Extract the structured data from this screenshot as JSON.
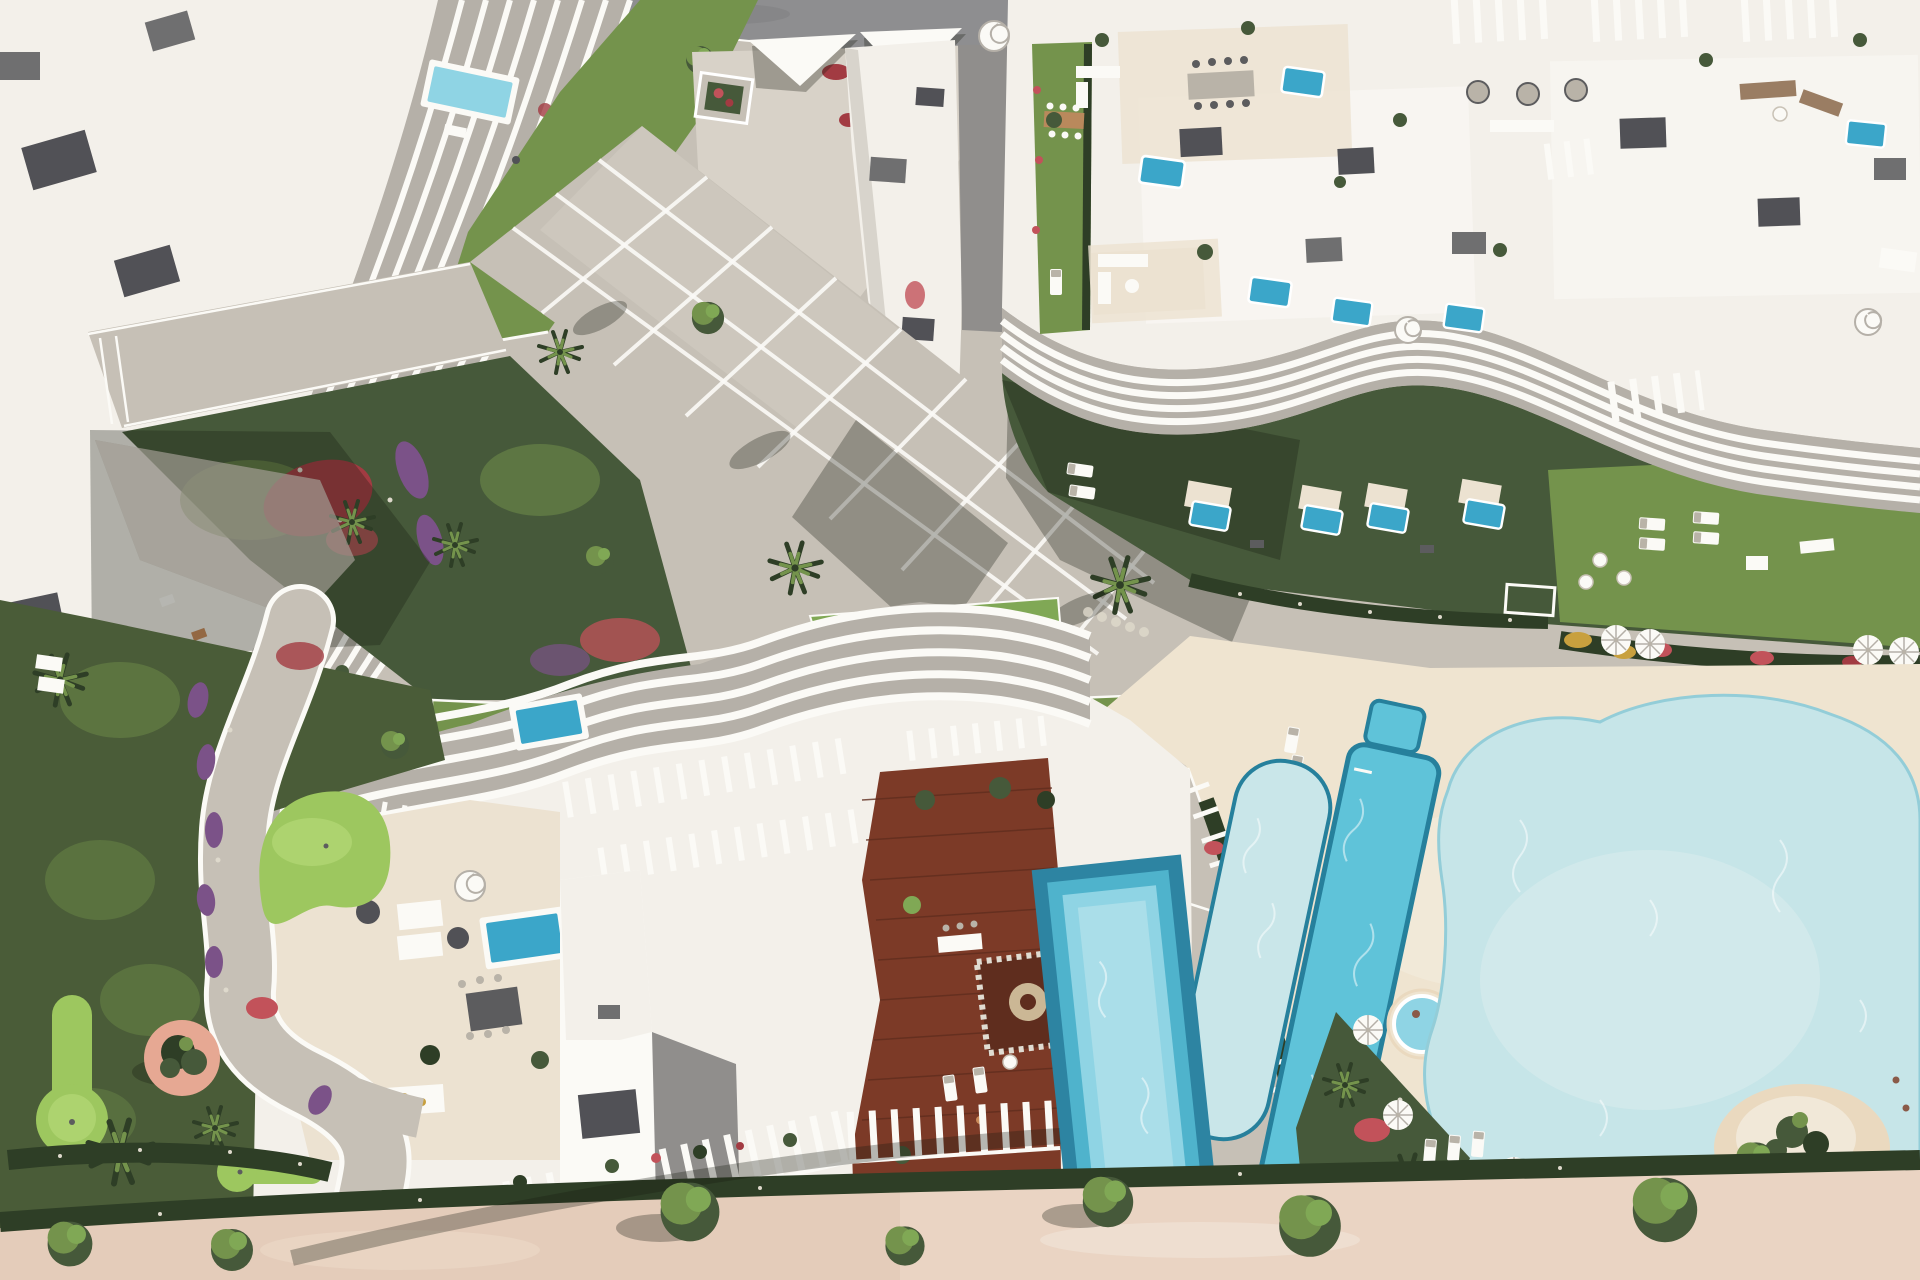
{
  "colors": {
    "paving": "#c6c0b6",
    "pavingLight": "#d8d2c8",
    "pavingShadow": "#908e8c",
    "road": "#8e8e90",
    "white": "#f3f0ea",
    "whiteBright": "#fbfaf6",
    "whiteShade": "#d8d4cc",
    "finGap": "#b5b0a8",
    "roofBox": "#515156",
    "boxGray": "#6f6f70",
    "terrace": "#ece2d1",
    "sand": "#efe4d0",
    "promenade": "#e4ccba",
    "promenadeLight": "#eedbca",
    "lawn": "#74934c",
    "lawnBright": "#80a855",
    "lawnDark": "#46593a",
    "lawnShadow": "#2e3e26",
    "putting": "#9dc75f",
    "puttingLight": "#b8da7a",
    "flowerRed": "#a23b42",
    "flowerCrimson": "#c2525a",
    "flowerPurple": "#7b5288",
    "flowerWhite": "#ded9cc",
    "flowerYellow": "#c8a03e",
    "poolRim": "#26809c",
    "poolMid": "#3ba6c9",
    "poolLap": "#5fc3d9",
    "poolPale": "#c9e6e9",
    "poolBand1": "#2d84a2",
    "poolBand2": "#4fb3cc",
    "poolBand3": "#8fd4e4",
    "poolInner": "#aadee9",
    "lagoon": "#c6e5e8",
    "lagoonEdge": "#93cdd8",
    "wood": "#7c3a27",
    "woodDark": "#5f2d1e",
    "woodTable": "#b9895c",
    "planterPink": "#e6a893",
    "sandIsland": "#ead9bf",
    "furnGray": "#b9b3a8",
    "furnDark": "#5c5c5e",
    "furnBeige": "#cfc5b2",
    "cushionTeal": "#3fae9e",
    "shadow": "rgba(24,28,18,0.30)"
  }
}
